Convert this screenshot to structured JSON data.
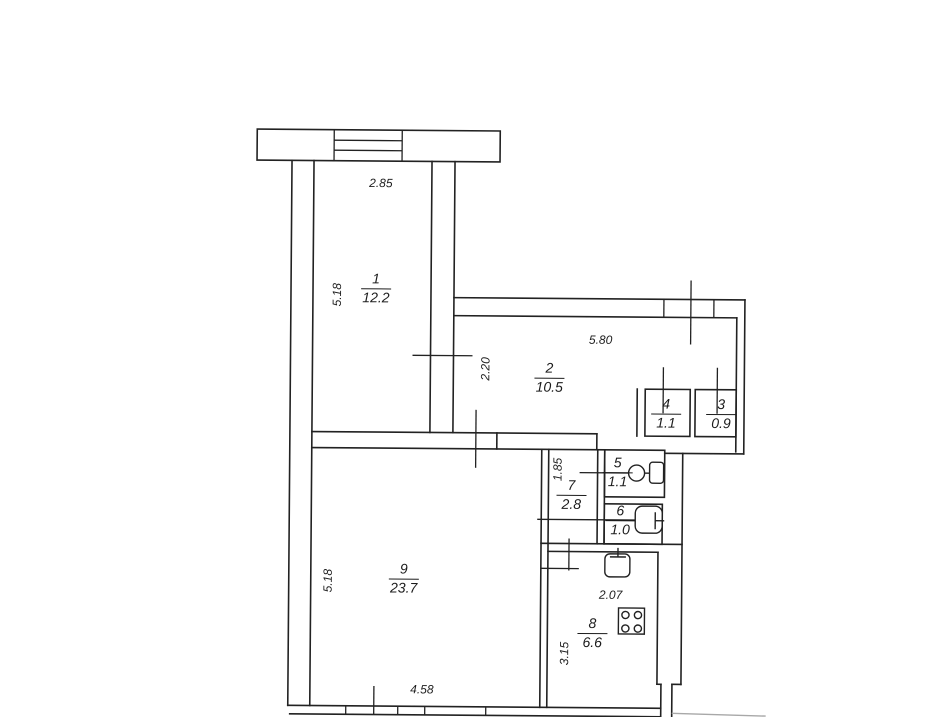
{
  "colors": {
    "line": "#222222",
    "background": "#ffffff",
    "faint_line": "#a8a8a8"
  },
  "rooms": [
    {
      "number": "1",
      "area": "12.2"
    },
    {
      "number": "2",
      "area": "10.5"
    },
    {
      "number": "3",
      "area": "0.9"
    },
    {
      "number": "4",
      "area": "1.1"
    },
    {
      "number": "5",
      "area": "1.1"
    },
    {
      "number": "6",
      "area": "1.0"
    },
    {
      "number": "7",
      "area": "2.8"
    },
    {
      "number": "8",
      "area": "6.6"
    },
    {
      "number": "9",
      "area": "23.7"
    }
  ],
  "dimensions": {
    "room1_width": "2.85",
    "room1_depth": "5.18",
    "room2_width": "5.80",
    "room2_depth": "2.20",
    "room7_depth": "1.85",
    "room8_width": "2.07",
    "room8_depth": "3.15",
    "room9_width": "4.58",
    "room9_depth": "5.18"
  },
  "fixtures": {
    "toilet": "toilet-icon",
    "bath": "bath-icon",
    "sink": "sink-icon",
    "stove": "stove-icon"
  }
}
